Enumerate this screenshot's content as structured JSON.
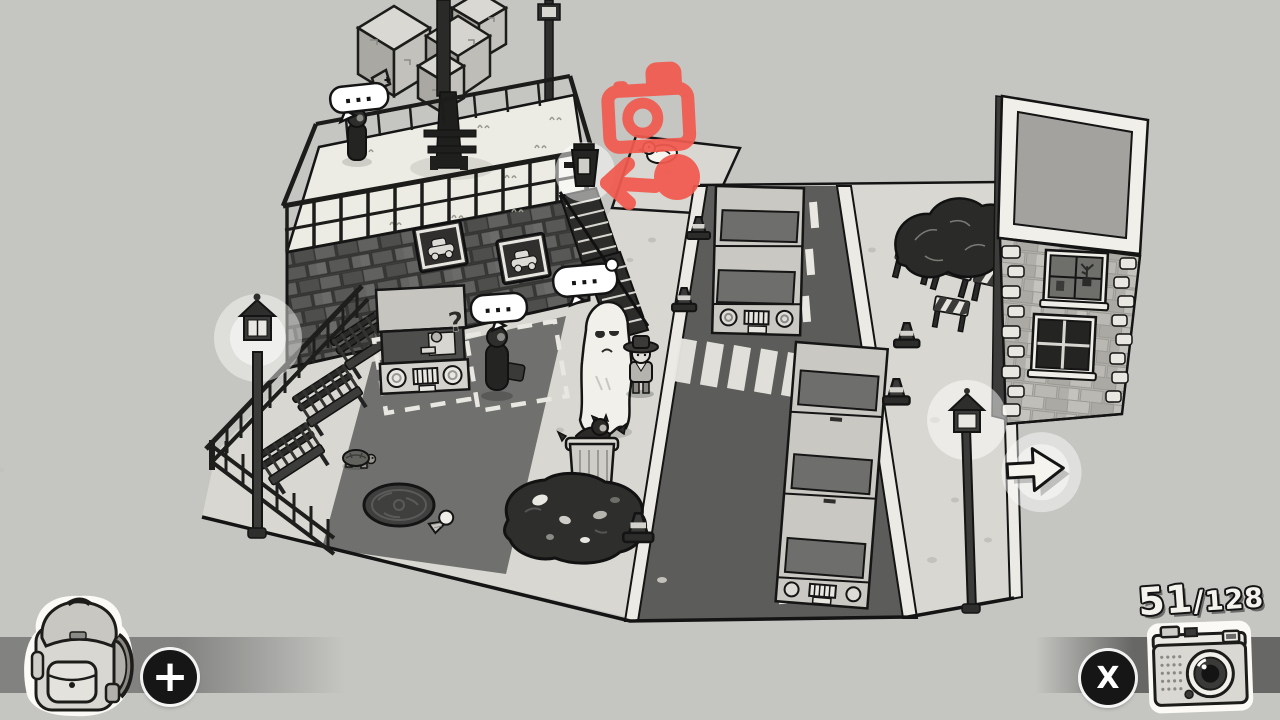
{
  "hud": {
    "backpack_button": {
      "label": "+"
    },
    "camera_button": {
      "label": "X"
    },
    "photo_counter": {
      "current": "51",
      "separator": "/",
      "total": "128"
    }
  },
  "scene": {
    "speech_bubbles": {
      "rooftop": "...",
      "ghost": "...",
      "parking": "..."
    },
    "question_mark": "?"
  },
  "colors": {
    "background": "#c5c6c2",
    "ink": "#161614",
    "accent_red": "#f25a4f",
    "plaza": "#d8d7d1",
    "road": "#5c5c5a",
    "hud_bar_left": "#828280",
    "hud_bar_right": "#676765"
  }
}
